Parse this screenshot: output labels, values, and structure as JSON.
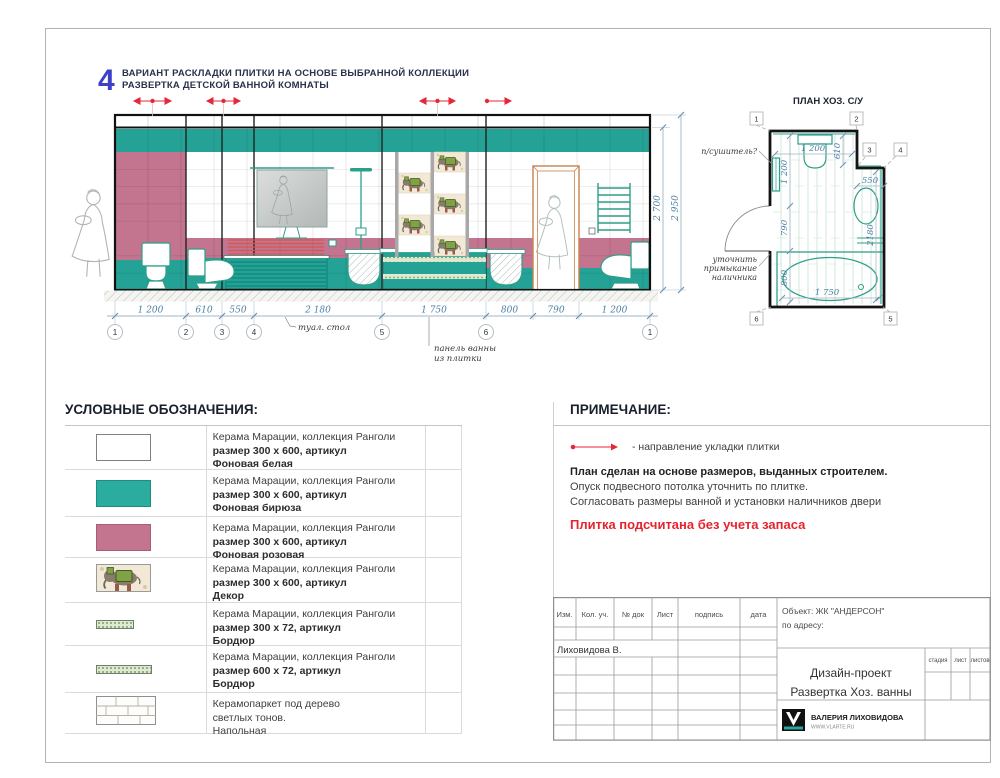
{
  "header": {
    "number": "4",
    "line1": "ВАРИАНТ РАСКЛАДКИ ПЛИТКИ НА ОСНОВЕ ВЫБРАННОЙ КОЛЛЕКЦИИ",
    "line2": "РАЗВЕРТКА ДЕТСКОЙ ВАННОЙ КОМНАТЫ"
  },
  "colors": {
    "teal": "#25A296",
    "pink": "#C3748F",
    "red_accent": "#E6273A",
    "dim_blue": "#4A7FA5",
    "title_blue": "#3C41C8",
    "warning_red": "#E8232E"
  },
  "elevation": {
    "dims": [
      "1 200",
      "610",
      "550",
      "2 180",
      "1 750",
      "800",
      "790",
      "1 200"
    ],
    "grid_bubbles": [
      "1",
      "2",
      "3",
      "4",
      "5",
      "6",
      "1"
    ],
    "height_dim_inner": "2 700",
    "height_dim_outer": "2 950",
    "note_vanity": "туал. стол",
    "note_bath_line1": "панель ванны",
    "note_bath_line2": "из плитки"
  },
  "plan": {
    "title": "ПЛАН ХОЗ. С/У",
    "markers": [
      "1",
      "2",
      "3",
      "4",
      "5",
      "6"
    ],
    "dim_top": "1 200",
    "dim_610": "610",
    "dim_left_1200": "1 200",
    "dim_550": "550",
    "dim_790": "790",
    "dim_2180": "2180",
    "dim_800": "800",
    "dim_bath": "1 750",
    "label_dryer": "п/сушитель?",
    "label_casing_line1": "уточнить",
    "label_casing_line2": "примыкание",
    "label_casing_line3": "наличника"
  },
  "legend": {
    "title": "УСЛОВНЫЕ ОБОЗНАЧЕНИЯ:",
    "rows": [
      {
        "line1": "Керама Марации, коллекция Ранголи",
        "line2": "размер 300 х 600, артикул",
        "line3": "Фоновая белая"
      },
      {
        "line1": "Керама Марации, коллекция Ранголи",
        "line2": "размер 300 х 600, артикул",
        "line3": "Фоновая бирюза"
      },
      {
        "line1": "Керама Марации, коллекция Ранголи",
        "line2": "размер 300 х 600, артикул",
        "line3": "Фоновая розовая"
      },
      {
        "line1": "Керама Марации, коллекция Ранголи",
        "line2": "размер 300 х 600, артикул",
        "line3": "Декор"
      },
      {
        "line1": "Керама Марации, коллекция Ранголи",
        "line2": "размер 300 х 72, артикул",
        "line3": "Бордюр"
      },
      {
        "line1": "Керама Марации, коллекция Ранголи",
        "line2": "размер 600 х 72, артикул",
        "line3": "Бордюр"
      },
      {
        "line1": "Керамопаркет под дерево",
        "line2": "светлых тонов.",
        "line3": "Напольная"
      }
    ]
  },
  "notes": {
    "title": "ПРИМЕЧАНИЕ:",
    "arrow_label": "- направление укладки плитки",
    "line1": "План сделан на основе размеров, выданных строителем.",
    "line2": "Опуск подвесного потолка уточнить по плитке.",
    "line3": "Согласовать размеры ванной и установки наличников двери",
    "warning": "Плитка подсчитана без учета запаса"
  },
  "titleblock": {
    "col_izm": "Изм.",
    "col_kol": "Кол. уч.",
    "col_doc": "№ док",
    "col_list": "Лист",
    "col_sign": "подпись",
    "col_date": "дата",
    "author": "Лиховидова В.",
    "object_line1": "Объект: ЖК \"АНДЕРСОН\"",
    "object_line2": "по адресу:",
    "project_line1": "Дизайн-проект",
    "project_line2": "Развертка Хоз. ванны",
    "stage": "стадия",
    "sheet": "лист",
    "sheets": "листов",
    "brand": "ВАЛЕРИЯ ЛИХОВИДОВА",
    "site": "WWW.VLARTE.RU"
  }
}
